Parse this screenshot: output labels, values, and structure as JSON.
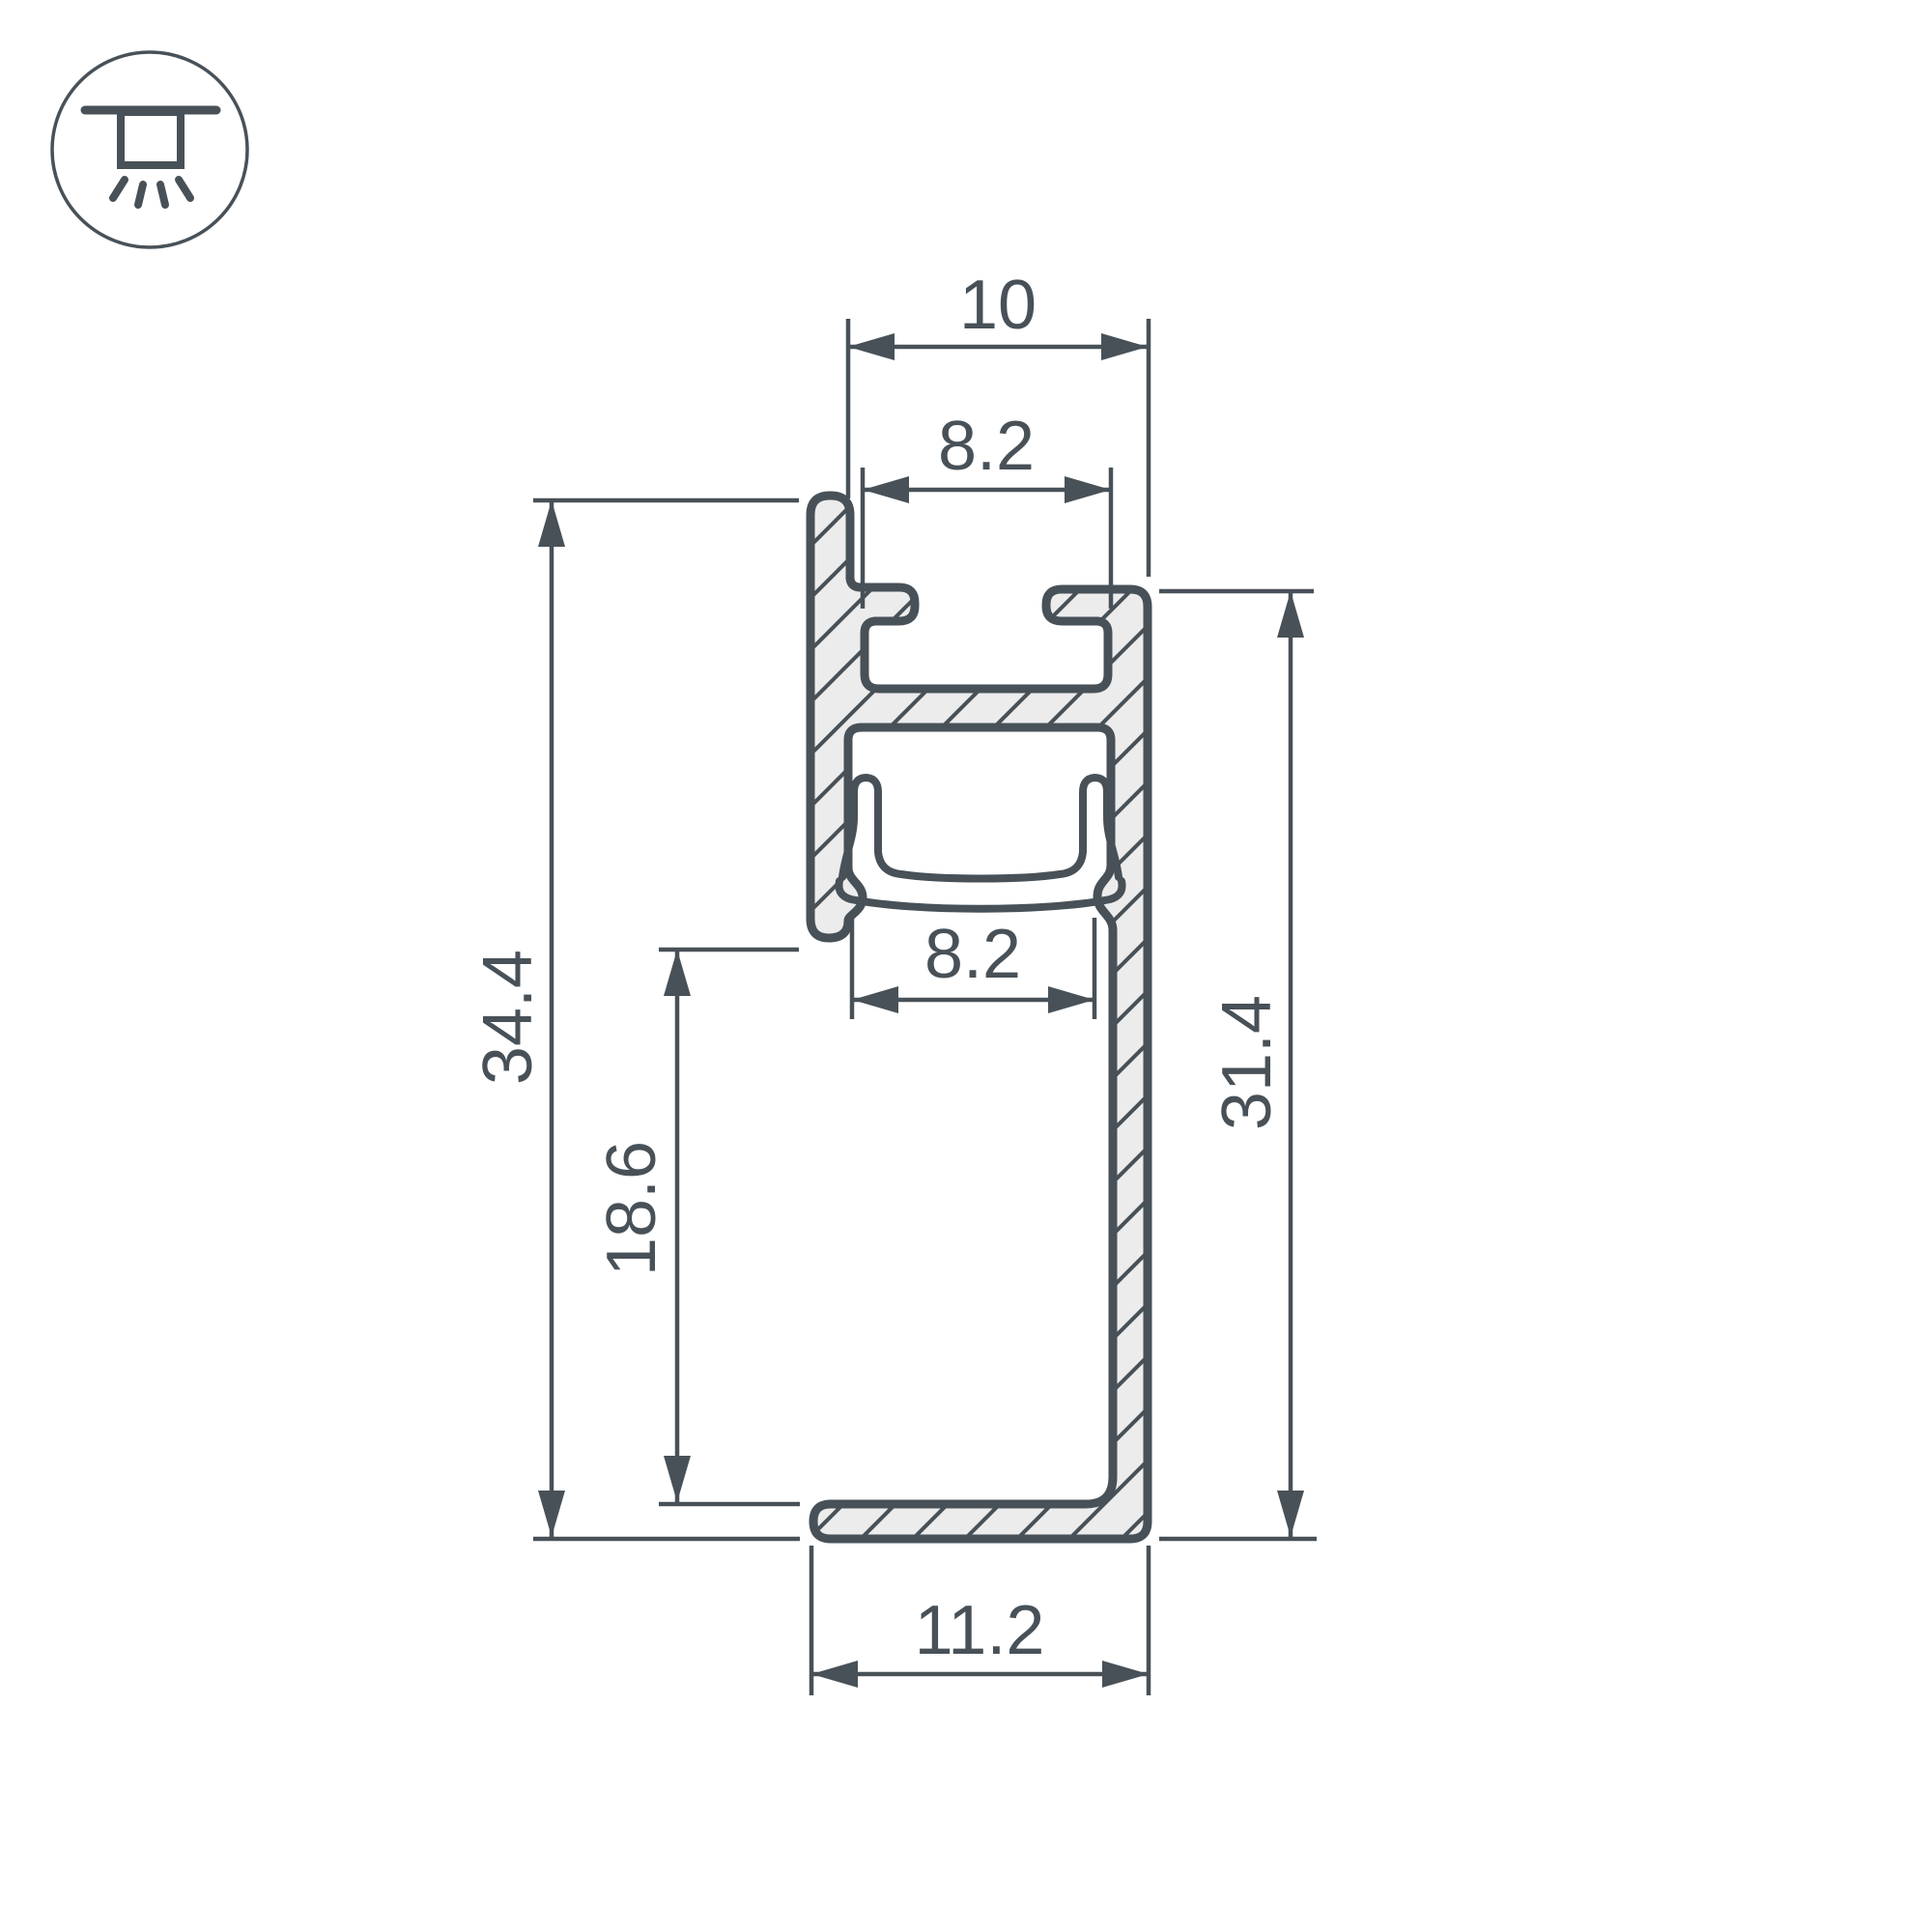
{
  "icon": {
    "name": "recessed-downlight-icon"
  },
  "dims": {
    "top_width": "10",
    "slot_width": "8.2",
    "diffuser_width": "8.2",
    "overall_height": "34.4",
    "inner_height": "18.6",
    "side_height": "31.4",
    "bottom_width": "11.2"
  },
  "colors": {
    "line": "#485158",
    "fill": "#ececec",
    "background": "#ffffff"
  }
}
